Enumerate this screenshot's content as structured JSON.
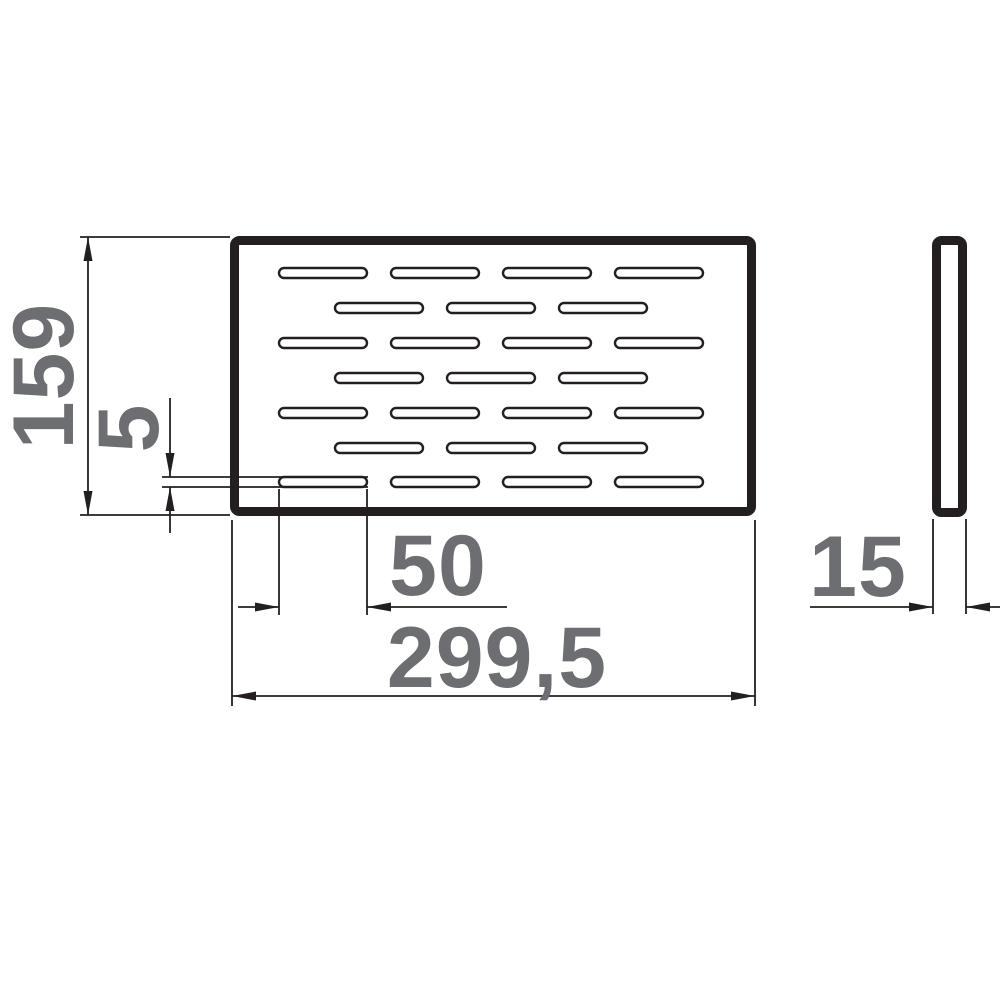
{
  "drawing": {
    "title": "perforated plate technical drawing",
    "dimensions": {
      "plate_height": "159",
      "slot_height": "5",
      "slot_length": "50",
      "plate_width": "299,5",
      "plate_thickness": "15"
    },
    "views": {
      "front": "front view with slotted perforation pattern",
      "side": "side profile view"
    },
    "slots": {
      "rows": 7,
      "slots_in_odd_rows": 4,
      "slots_in_even_rows": 3,
      "total": 25
    },
    "colors": {
      "line": "#231f20",
      "dimension_text": "#6d6e71",
      "background": "#ffffff"
    }
  }
}
